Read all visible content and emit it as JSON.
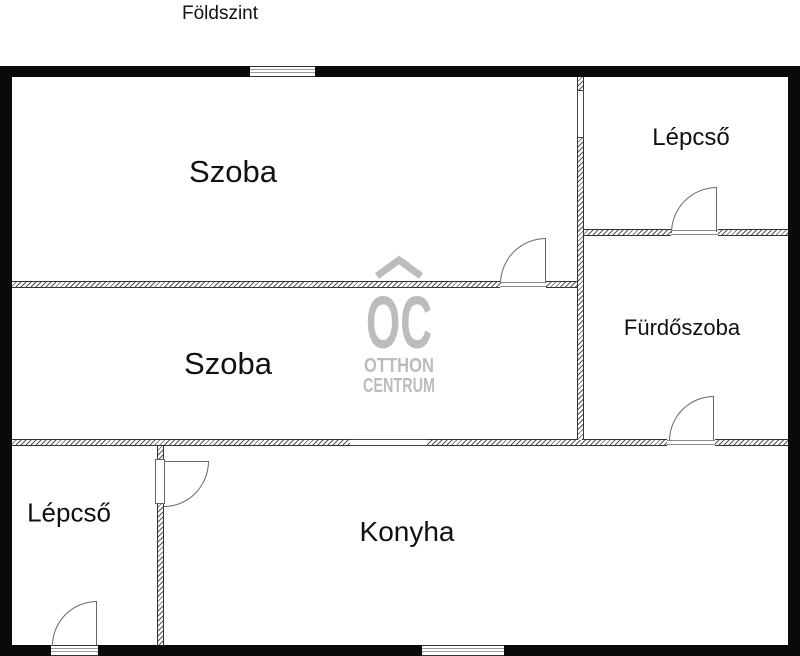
{
  "title": "Földszint",
  "rooms": {
    "szoba1": {
      "label": "Szoba"
    },
    "szoba2": {
      "label": "Szoba"
    },
    "lepcso_top": {
      "label": "Lépcső"
    },
    "furdoszoba": {
      "label": "Fürdőszoba"
    },
    "lepcso_bottom": {
      "label": "Lépcső"
    },
    "konyha": {
      "label": "Konyha"
    }
  },
  "watermark": {
    "initials": "OC",
    "line1": "OTTHON",
    "line2": "CENTRUM"
  },
  "colors": {
    "background": "#ffffff",
    "outer_wall": "#0a0a0a",
    "interior_line": "#555555",
    "door_line": "#666666",
    "watermark": "#bcbcbc",
    "text": "#111111"
  }
}
